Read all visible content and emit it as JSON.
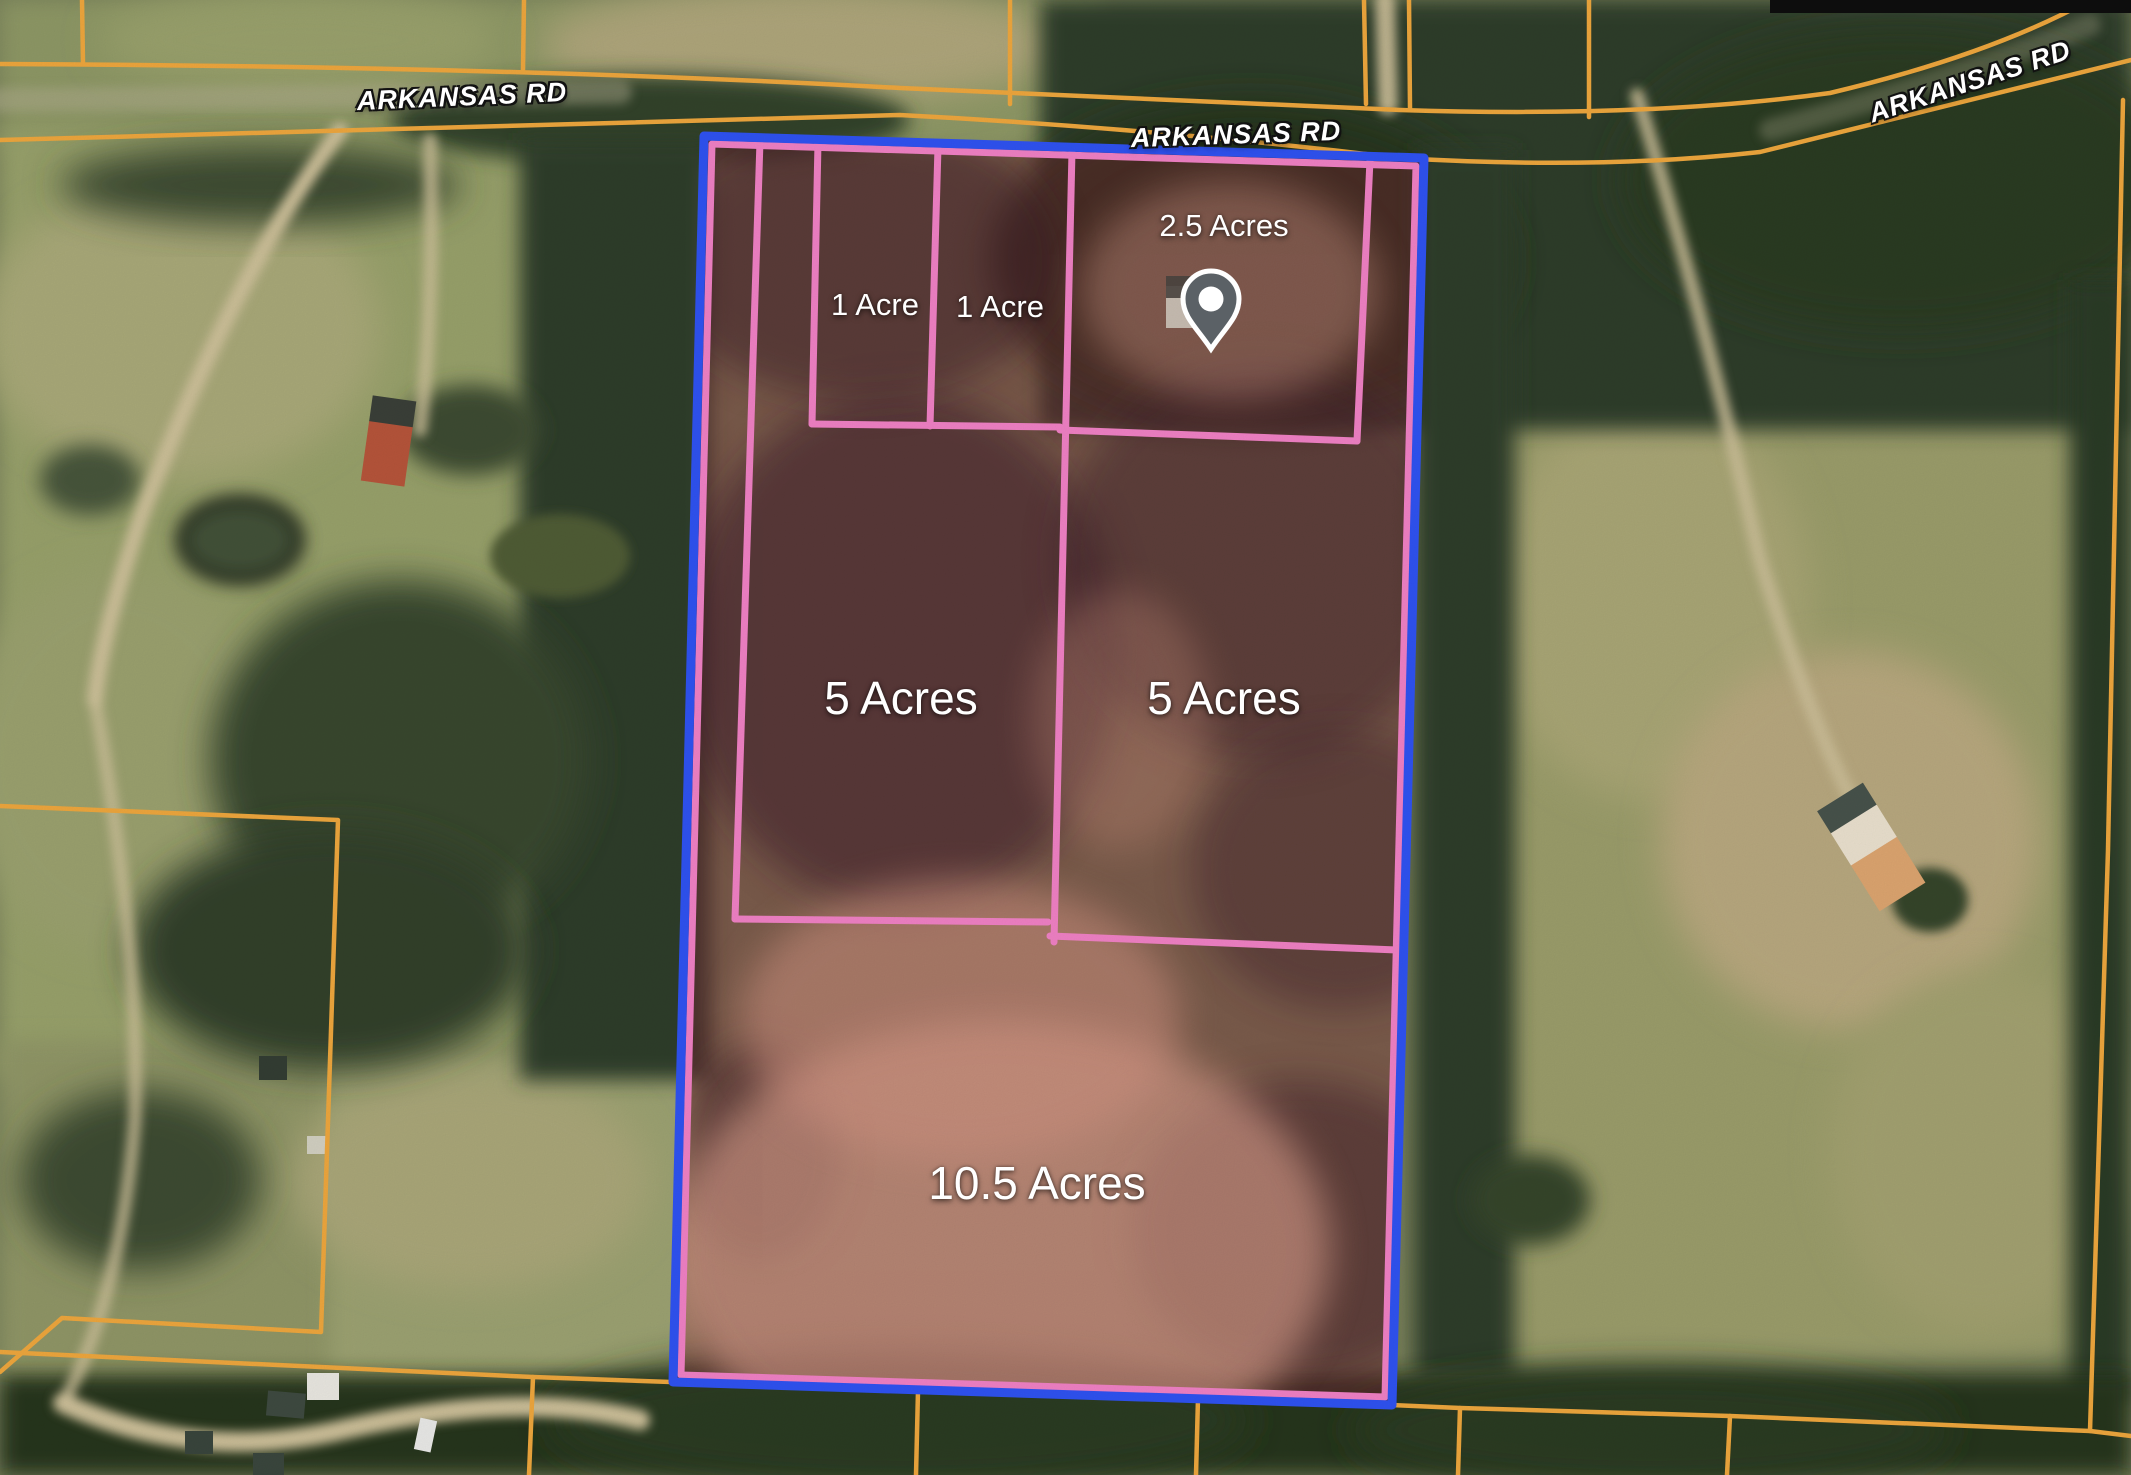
{
  "map": {
    "road_labels": [
      {
        "text": "ARKANSAS RD",
        "x": 462,
        "y": 97,
        "rotation": -2.5
      },
      {
        "text": "ARKANSAS RD",
        "x": 1236,
        "y": 135,
        "rotation": -2
      },
      {
        "text": "ARKANSAS RD",
        "x": 1970,
        "y": 82,
        "rotation": -18
      }
    ],
    "lot_labels": [
      {
        "text": "1 Acre",
        "x": 875,
        "y": 305,
        "size": "small"
      },
      {
        "text": "1 Acre",
        "x": 1000,
        "y": 307,
        "size": "small"
      },
      {
        "text": "2.5 Acres",
        "x": 1224,
        "y": 226,
        "size": "small"
      },
      {
        "text": "5 Acres",
        "x": 901,
        "y": 698,
        "size": "large"
      },
      {
        "text": "5 Acres",
        "x": 1224,
        "y": 698,
        "size": "large"
      },
      {
        "text": "10.5 Acres",
        "x": 1037,
        "y": 1183,
        "size": "large"
      }
    ],
    "marker": {
      "name": "location-pin",
      "x": 1211,
      "y": 306
    },
    "colors": {
      "boundary_blue": "#2f52f0",
      "lot_pink": "#ef80c4",
      "parcel_orange": "#eda63d",
      "label_white": "#ffffff",
      "pin_gray": "#5b6166"
    }
  }
}
